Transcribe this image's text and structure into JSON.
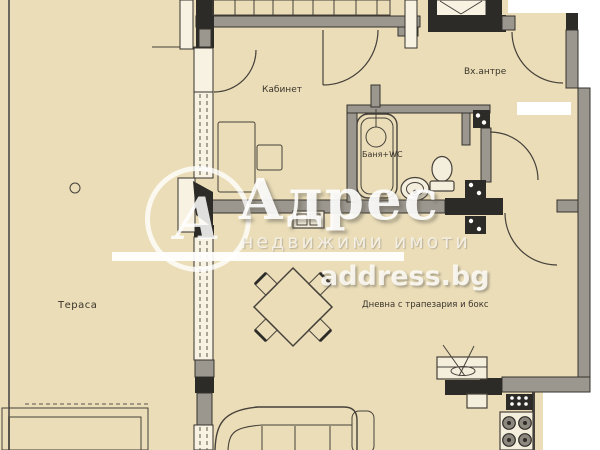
{
  "rooms": {
    "terrace": "Тераса",
    "office": "Кабинет",
    "entry": "Вх.антре",
    "bathroom": "Баня+WC",
    "living": "Дневна с трапезария и бокс"
  },
  "watermark": {
    "logo_letter": "А",
    "brand": "Адрес",
    "tagline": "недвижими имоти",
    "site": "address.bg"
  },
  "colors": {
    "floor": "#eaddb8",
    "outside": "#ffffff",
    "wall_gray": "#9b978f",
    "wall_black": "#2d2b27",
    "line": "#46413a"
  }
}
